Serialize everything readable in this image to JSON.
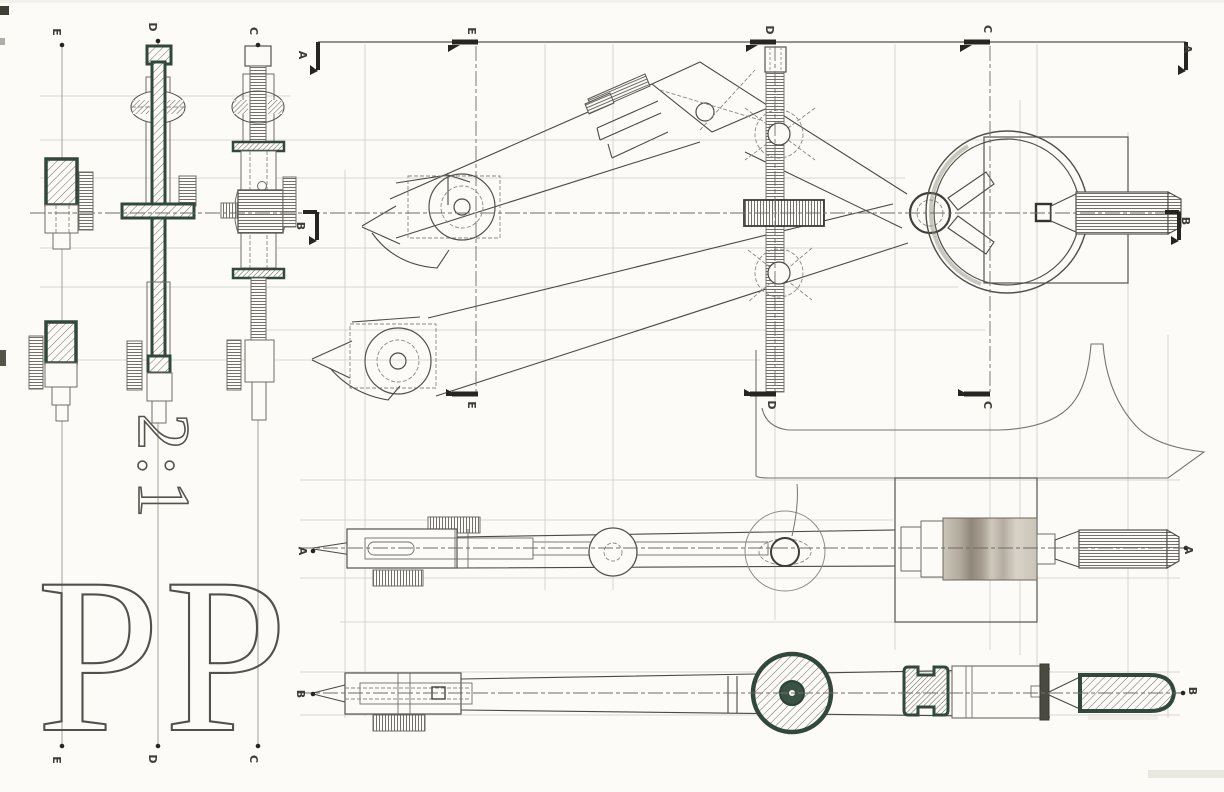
{
  "sheet": {
    "scale_label": "2:1",
    "sheet_letters": "PP",
    "section_letters": {
      "a": "A",
      "b": "B",
      "c": "C",
      "d": "D",
      "e": "E"
    },
    "colors": {
      "paper": "#fcfbf7",
      "ink": "#4b4a44",
      "bold_outline": "#31483a",
      "faint_line": "#c9c8bf"
    }
  }
}
